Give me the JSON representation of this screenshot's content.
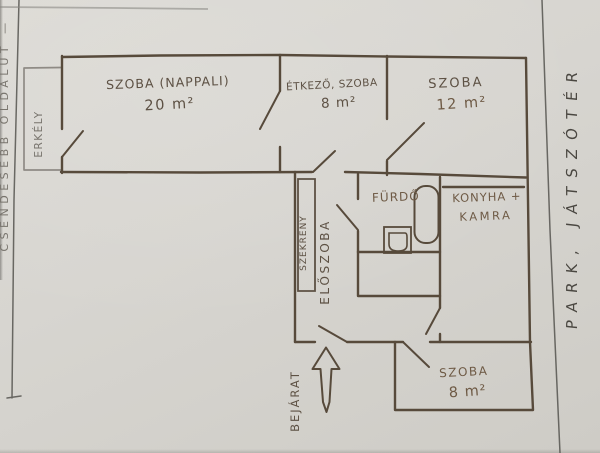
{
  "annotations": {
    "left_note": "CSENDESEBB OLDALÚT —",
    "right_note": "PARK, JÁTSZÓTÉR"
  },
  "rooms": {
    "living": {
      "name": "SZOBA (NAPPALI)",
      "area": "20 m²"
    },
    "dining": {
      "name": "ÉTKEZŐ, SZOBA",
      "area": "8 m²"
    },
    "bedroom": {
      "name": "SZOBA",
      "area": "12 m²"
    },
    "small_room": {
      "name": "SZOBA",
      "area": "8 m²"
    },
    "bathroom": {
      "name": "FÜRDŐ"
    },
    "kitchen": {
      "line1": "KONYHA +",
      "line2": "KAMRA"
    },
    "hallway": {
      "name": "ELŐSZOBA"
    },
    "closet": {
      "name": "SZEKRÉNY"
    },
    "balcony": {
      "name": "ERKÉLY"
    },
    "entrance": {
      "name": "BEJÁRAT"
    }
  },
  "colors": {
    "paper": "#d7d5d0",
    "marker_ink": "#574a3b",
    "label_ink": "#6e5a45",
    "pencil": "#8f8b85",
    "ruled_pen": "#55544f"
  }
}
